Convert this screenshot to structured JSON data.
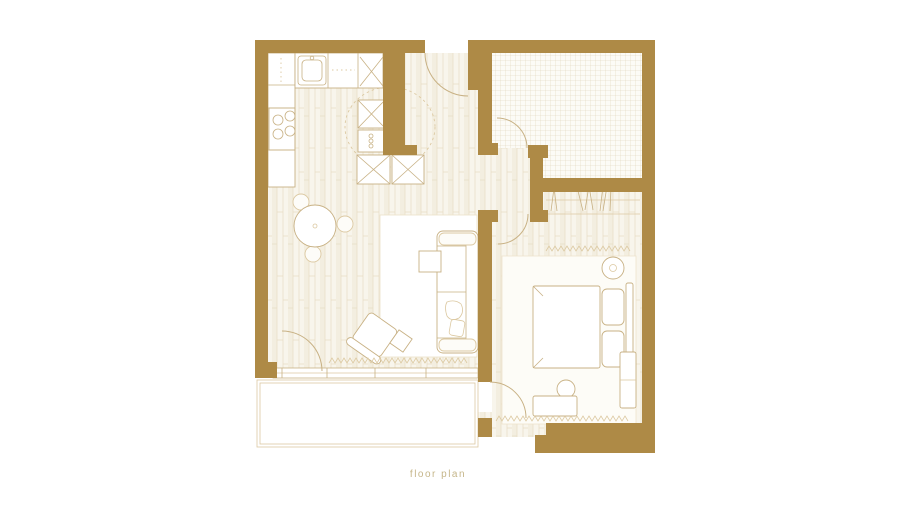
{
  "caption": {
    "text": "floor plan"
  },
  "colors": {
    "background": "#ffffff",
    "wall": "#ae8a46",
    "outline": "#c8b184",
    "outline_soft": "#dcc9a2",
    "floor_bg": "#f8f5ec",
    "floor_line": "#e8ddc5",
    "tile_line": "#ddd1b5",
    "grid_bg": "#fcfbf6",
    "caption_text": "#c6b68a"
  }
}
